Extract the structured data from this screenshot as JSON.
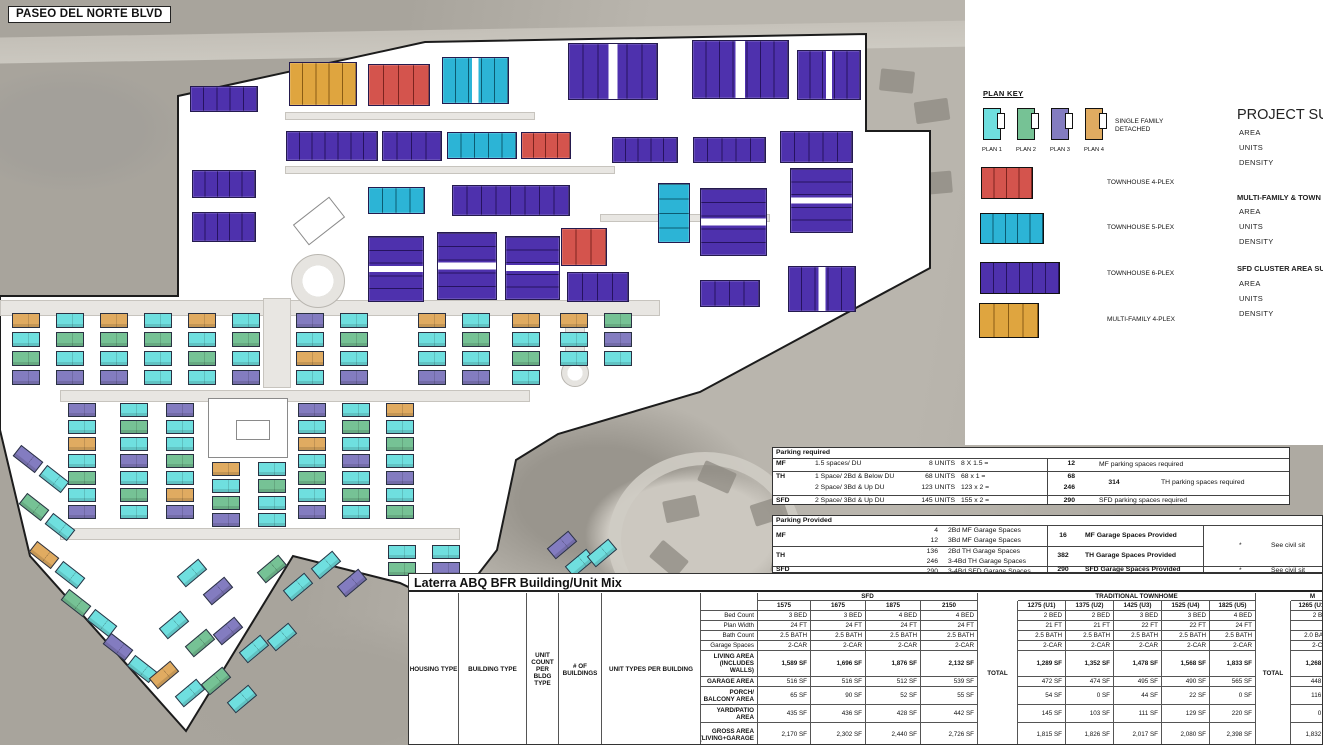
{
  "map": {
    "street_label": "PASEO DEL NORTE BLVD"
  },
  "plan_key": {
    "title": "PLAN KEY",
    "sfd_label": "SINGLE FAMILY DETACHED",
    "sfd_plans": [
      {
        "label": "PLAN 1",
        "color": "#6fdfdf"
      },
      {
        "label": "PLAN 2",
        "color": "#76c295"
      },
      {
        "label": "PLAN 3",
        "color": "#837cc0"
      },
      {
        "label": "PLAN 4",
        "color": "#e0ab61"
      }
    ],
    "items": [
      {
        "label": "TOWNHOUSE 4-PLEX",
        "color": "#d4544d",
        "units": 4
      },
      {
        "label": "TOWNHOUSE 5-PLEX",
        "color": "#2cb4d6",
        "units": 5
      },
      {
        "label": "TOWNHOUSE 6-PLEX",
        "color": "#4e31ad",
        "units": 6
      },
      {
        "label": "MULTI-FAMILY 4-PLEX",
        "color": "#dfa53f",
        "units": 4
      }
    ]
  },
  "project_summary": {
    "title": "PROJECT SUM",
    "rows1": [
      "AREA",
      "UNITS",
      "DENSITY"
    ],
    "section2": "MULTI-FAMILY & TOWN",
    "rows2": [
      "AREA",
      "UNITS",
      "DENSITY"
    ],
    "section3": "SFD CLUSTER AREA SU",
    "rows3": [
      "AREA",
      "UNITS",
      "DENSITY"
    ]
  },
  "parking_required": {
    "title": "Parking required",
    "rows": [
      {
        "type": "MF",
        "lines": [
          [
            "1.5 spaces/ DU",
            "8 UNITS",
            "8 X 1.5 ="
          ]
        ],
        "col1": [
          "12"
        ],
        "col2": "",
        "note": "MF parking spaces required"
      },
      {
        "type": "TH",
        "lines": [
          [
            "1 Space/ 2Bd & Below DU",
            "68 UNITS",
            "68 x 1 ="
          ],
          [
            "2 Space/ 3Bd & Up DU",
            "123 UNITS",
            "123 x 2 ="
          ]
        ],
        "col1": [
          "68",
          "246"
        ],
        "col2": "314",
        "note": "TH parking spaces required"
      },
      {
        "type": "SFD",
        "lines": [
          [
            "2 Space/ 3Bd & Up DU",
            "145 UNITS",
            "155 x 2 ="
          ]
        ],
        "col1": [
          "290"
        ],
        "col2": "",
        "note": "SFD parking spaces required"
      }
    ]
  },
  "parking_provided": {
    "title": "Parking Provided",
    "rows": [
      {
        "type": "MF",
        "lines": [
          [
            "4",
            "2Bd MF Garage Spaces"
          ],
          [
            "12",
            "3Bd MF Garage Spaces"
          ]
        ],
        "total": "16",
        "total_desc": "MF Garage Spaces Provided"
      },
      {
        "type": "TH",
        "lines": [
          [
            "136",
            "2Bd TH Garage Spaces"
          ],
          [
            "246",
            "3-4Bd TH Garage Spaces"
          ]
        ],
        "total": "382",
        "total_desc": "TH Garage Spaces Provided"
      },
      {
        "type": "SFD",
        "lines": [
          [
            "290",
            "3-4Bd SFD Garage Spaces"
          ]
        ],
        "total": "290",
        "total_desc": "SFD Garage Spaces Provided"
      }
    ],
    "notes": [
      {
        "mark": "*",
        "text": "See civil sit"
      },
      {
        "mark": "*",
        "text": "See civil sit"
      }
    ]
  },
  "unit_mix": {
    "title": "Laterra ABQ BFR Building/Unit Mix",
    "left_headers": [
      "HOUSING TYPE",
      "BUILDING TYPE",
      "UNIT COUNT PER BLDG TYPE",
      "# OF BUILDINGS",
      "UNIT TYPES PER BUILDING"
    ],
    "row_labels": [
      "Bed Count",
      "Plan Width",
      "Bath Count",
      "Garage Spaces",
      "LIVING AREA (INCLUDES WALLS)",
      "GARAGE AREA",
      "PORCH/ BALCONY AREA",
      "YARD/PATIO AREA",
      "GROSS AREA (LIVING+GARAGE"
    ],
    "totals_label": "TOTAL",
    "groups": [
      {
        "name": "SFD",
        "plans": [
          "1575",
          "1675",
          "1875",
          "2150"
        ],
        "has_total": true,
        "rows": [
          [
            "3 BED",
            "3 BED",
            "4 BED",
            "4 BED"
          ],
          [
            "24 FT",
            "24 FT",
            "24 FT",
            "24 FT"
          ],
          [
            "2.5 BATH",
            "2.5 BATH",
            "2.5 BATH",
            "2.5 BATH"
          ],
          [
            "2-CAR",
            "2-CAR",
            "2-CAR",
            "2-CAR"
          ],
          [
            "1,589 SF",
            "1,696 SF",
            "1,876 SF",
            "2,132 SF"
          ],
          [
            "516 SF",
            "516 SF",
            "512 SF",
            "539 SF"
          ],
          [
            "65 SF",
            "90 SF",
            "52 SF",
            "55 SF"
          ],
          [
            "435 SF",
            "436 SF",
            "428 SF",
            "442 SF"
          ],
          [
            "2,170 SF",
            "2,302 SF",
            "2,440 SF",
            "2,726 SF"
          ]
        ]
      },
      {
        "name": "TRADITIONAL TOWNHOME",
        "plans": [
          "1275 (U1)",
          "1375 (U2)",
          "1425 (U3)",
          "1525 (U4)",
          "1825 (U5)"
        ],
        "has_total": true,
        "rows": [
          [
            "2 BED",
            "2 BED",
            "3 BED",
            "3 BED",
            "4 BED"
          ],
          [
            "21 FT",
            "21 FT",
            "22 FT",
            "22 FT",
            "24 FT"
          ],
          [
            "2.5 BATH",
            "2.5 BATH",
            "2.5 BATH",
            "2.5 BATH",
            "2.5 BATH"
          ],
          [
            "2-CAR",
            "2-CAR",
            "2-CAR",
            "2-CAR",
            "2-CAR"
          ],
          [
            "1,289 SF",
            "1,352 SF",
            "1,478 SF",
            "1,568 SF",
            "1,833 SF"
          ],
          [
            "472 SF",
            "474 SF",
            "495 SF",
            "490 SF",
            "565 SF"
          ],
          [
            "54 SF",
            "0 SF",
            "44 SF",
            "22 SF",
            "0 SF"
          ],
          [
            "145 SF",
            "103 SF",
            "111 SF",
            "129 SF",
            "220 SF"
          ],
          [
            "1,815 SF",
            "1,826 SF",
            "2,017 SF",
            "2,080 SF",
            "2,398 SF"
          ]
        ]
      },
      {
        "name": "M",
        "plans": [
          "1265 (U1)"
        ],
        "has_total": false,
        "rows": [
          [
            "2 BED"
          ],
          [
            ""
          ],
          [
            "2.0 BATH"
          ],
          [
            "2-CAR"
          ],
          [
            "1,268 SF"
          ],
          [
            "448 SF"
          ],
          [
            "116 SF"
          ],
          [
            "0 SF"
          ],
          [
            "1,832 SF"
          ]
        ]
      }
    ]
  },
  "site_plan": {
    "colors": {
      "P": "#4e31ad",
      "C": "#2cb4d6",
      "R": "#d4544d",
      "G": "#dfa53f",
      "t": "#e0ab61",
      "c": "#6fdfdf",
      "g": "#76c295",
      "l": "#837cc0"
    },
    "townhouses": [
      [
        190,
        86,
        68,
        26,
        "P"
      ],
      [
        192,
        170,
        64,
        28,
        "P"
      ],
      [
        192,
        212,
        64,
        30,
        "P"
      ],
      [
        289,
        62,
        68,
        44,
        "G"
      ],
      [
        368,
        64,
        62,
        42,
        "R"
      ],
      [
        442,
        57,
        67,
        47,
        "C"
      ],
      [
        568,
        43,
        90,
        57,
        "P"
      ],
      [
        692,
        40,
        97,
        59,
        "P"
      ],
      [
        797,
        50,
        64,
        50,
        "P"
      ],
      [
        286,
        131,
        92,
        30,
        "P"
      ],
      [
        382,
        131,
        60,
        30,
        "P"
      ],
      [
        447,
        132,
        70,
        27,
        "C"
      ],
      [
        521,
        132,
        50,
        27,
        "R"
      ],
      [
        612,
        137,
        66,
        26,
        "P"
      ],
      [
        693,
        137,
        73,
        26,
        "P"
      ],
      [
        368,
        187,
        57,
        27,
        "C"
      ],
      [
        452,
        185,
        118,
        31,
        "P"
      ],
      [
        658,
        183,
        32,
        60,
        "C"
      ],
      [
        700,
        188,
        67,
        68,
        "P"
      ],
      [
        780,
        131,
        73,
        32,
        "P"
      ],
      [
        790,
        168,
        63,
        65,
        "P"
      ],
      [
        788,
        266,
        68,
        46,
        "P"
      ],
      [
        368,
        236,
        56,
        66,
        "P"
      ],
      [
        437,
        232,
        60,
        68,
        "P"
      ],
      [
        505,
        236,
        55,
        64,
        "P"
      ],
      [
        561,
        228,
        46,
        38,
        "R"
      ],
      [
        567,
        272,
        62,
        30,
        "P"
      ],
      [
        700,
        280,
        60,
        27,
        "P"
      ]
    ],
    "sfd_columns": [
      [
        12,
        313,
        19,
        15,
        "tcgl"
      ],
      [
        56,
        313,
        19,
        15,
        "cgcl"
      ],
      [
        100,
        313,
        19,
        15,
        "tgcl"
      ],
      [
        144,
        313,
        19,
        15,
        "cgcc"
      ],
      [
        188,
        313,
        19,
        15,
        "tcgc"
      ],
      [
        232,
        313,
        19,
        15,
        "cgcl"
      ],
      [
        296,
        313,
        19,
        15,
        "lctc"
      ],
      [
        340,
        313,
        19,
        15,
        "cgcl"
      ],
      [
        418,
        313,
        19,
        15,
        "tccl"
      ],
      [
        462,
        313,
        19,
        15,
        "cgcl"
      ],
      [
        512,
        313,
        19,
        15,
        "tcgc"
      ],
      [
        560,
        313,
        19,
        15,
        "tcc"
      ],
      [
        604,
        313,
        19,
        15,
        "glc"
      ],
      [
        68,
        403,
        17,
        14,
        "lctcgcl"
      ],
      [
        120,
        403,
        17,
        14,
        "cgclcgc"
      ],
      [
        166,
        403,
        17,
        14,
        "lccgctl"
      ],
      [
        298,
        403,
        17,
        14,
        "lctcgcl"
      ],
      [
        342,
        403,
        17,
        14,
        "cgclcgc"
      ],
      [
        386,
        403,
        17,
        14,
        "tcgclcg"
      ],
      [
        212,
        462,
        17,
        14,
        "tcgl"
      ],
      [
        258,
        462,
        17,
        14,
        "cgcc"
      ],
      [
        388,
        545,
        17,
        14,
        "cg"
      ],
      [
        432,
        545,
        17,
        14,
        "cl"
      ]
    ],
    "sfd_rotated": [
      [
        14,
        452,
        38,
        "l"
      ],
      [
        40,
        472,
        38,
        "c"
      ],
      [
        20,
        500,
        38,
        "g"
      ],
      [
        46,
        520,
        38,
        "c"
      ],
      [
        30,
        548,
        38,
        "t"
      ],
      [
        56,
        568,
        38,
        "c"
      ],
      [
        62,
        596,
        38,
        "g"
      ],
      [
        88,
        616,
        38,
        "c"
      ],
      [
        104,
        640,
        38,
        "l"
      ],
      [
        128,
        662,
        38,
        "c"
      ],
      [
        178,
        566,
        -40,
        "c"
      ],
      [
        204,
        584,
        -40,
        "l"
      ],
      [
        258,
        562,
        -40,
        "g"
      ],
      [
        284,
        580,
        -40,
        "c"
      ],
      [
        312,
        558,
        -40,
        "c"
      ],
      [
        338,
        576,
        -40,
        "l"
      ],
      [
        160,
        618,
        -40,
        "c"
      ],
      [
        186,
        636,
        -40,
        "g"
      ],
      [
        214,
        624,
        -40,
        "l"
      ],
      [
        240,
        642,
        -40,
        "c"
      ],
      [
        268,
        630,
        -40,
        "c"
      ],
      [
        150,
        668,
        -40,
        "t"
      ],
      [
        176,
        686,
        -40,
        "c"
      ],
      [
        202,
        674,
        -40,
        "g"
      ],
      [
        228,
        692,
        -40,
        "c"
      ],
      [
        548,
        538,
        -40,
        "l"
      ],
      [
        566,
        556,
        -40,
        "c"
      ],
      [
        588,
        546,
        -40,
        "c"
      ]
    ],
    "roads": [
      [
        0,
        300,
        660,
        16
      ],
      [
        60,
        390,
        470,
        12
      ],
      [
        60,
        528,
        400,
        12
      ],
      [
        263,
        298,
        28,
        90
      ],
      [
        285,
        112,
        250,
        8
      ],
      [
        285,
        166,
        330,
        8
      ],
      [
        600,
        214,
        170,
        8
      ],
      [
        565,
        316,
        20,
        45
      ]
    ],
    "roundabouts": [
      [
        318,
        281,
        27
      ],
      [
        575,
        373,
        14
      ]
    ],
    "amenities": [
      [
        208,
        398,
        80,
        60,
        0
      ],
      [
        236,
        420,
        34,
        20,
        0
      ],
      [
        296,
        208,
        46,
        26,
        -38
      ]
    ]
  }
}
